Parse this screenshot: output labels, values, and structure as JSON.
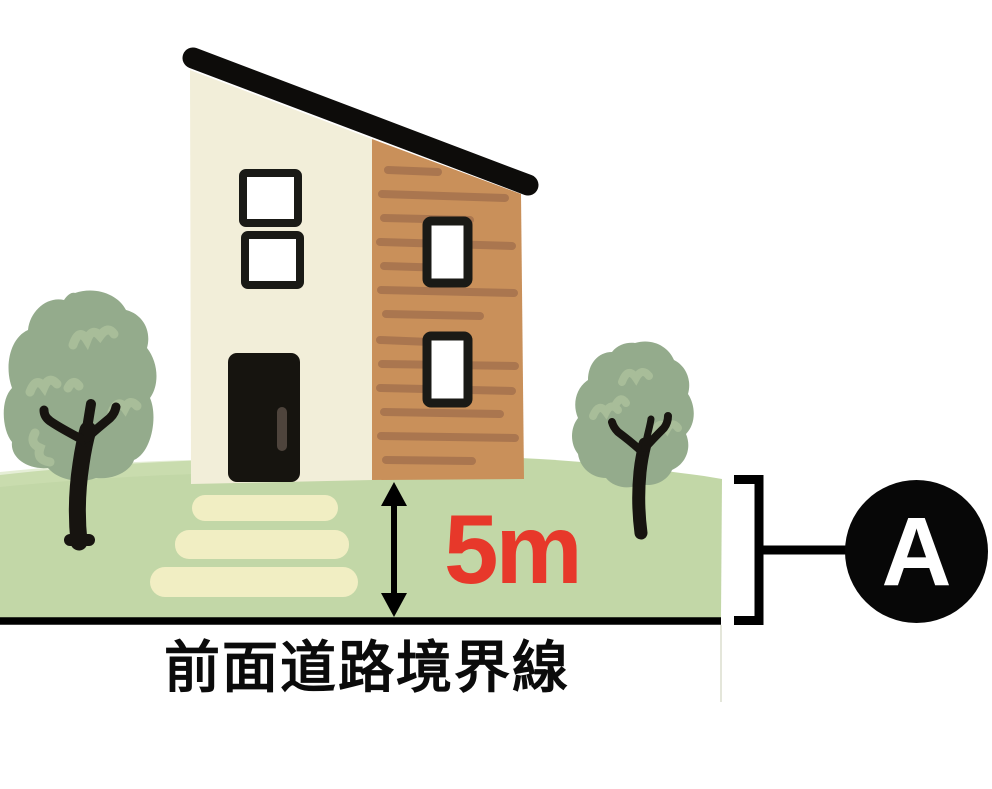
{
  "diagram": {
    "measurement_label": {
      "text": "5m",
      "color": "#e7382a"
    },
    "road_boundary_label": {
      "text": "前面道路境界線",
      "color": "#0b0b0b"
    },
    "marker_badge": {
      "text": "A",
      "background": "#070707",
      "text_color": "#ffffff"
    },
    "palette": {
      "roof": "#0d0c0a",
      "wall_cream": "#f2eed9",
      "wall_wood": "#c9905a",
      "wood_stripe": "#aa764f",
      "window_frame": "#1a1a16",
      "door": "#16140f",
      "door_handle": "#4e443c",
      "grass": "#c2d7a7",
      "grass_highlight": "#cfe0b5",
      "steps": "#f1eec3",
      "foliage": "#94ab8c",
      "foliage_highlight": "#a8bd99",
      "trunk": "#171410",
      "boundary_line": "#000000",
      "bracket": "#000000"
    }
  }
}
